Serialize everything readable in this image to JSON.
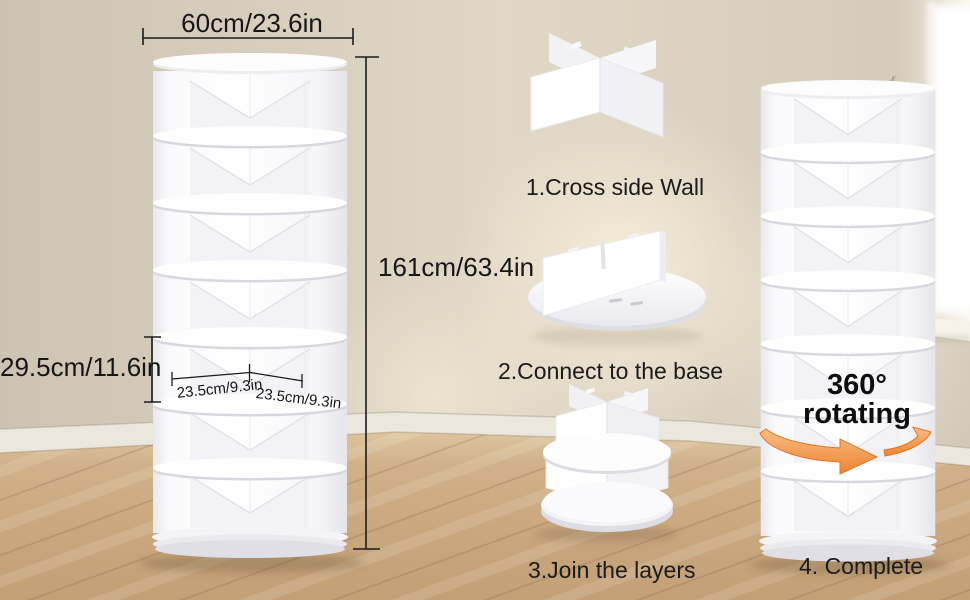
{
  "scene": {
    "labels": {
      "width": "60cm/23.6in",
      "height": "161cm/63.4in",
      "tier_height": "29.5cm/11.6in",
      "depth_left": "23.5cm/9.3in",
      "depth_right": "23.5cm/9.3in"
    },
    "steps": {
      "step1": "1.Cross side Wall",
      "step2": "2.Connect to the base",
      "step3": "3.Join the layers",
      "step4": "4. Complete"
    },
    "feature": {
      "line1": "360°",
      "line2": "rotating"
    },
    "colors": {
      "accent_orange": "#EE8A38",
      "text": "#161616",
      "wall": "#D8CEBF",
      "floor": "#CBAA80",
      "product_white": "#FDFDFE"
    }
  }
}
